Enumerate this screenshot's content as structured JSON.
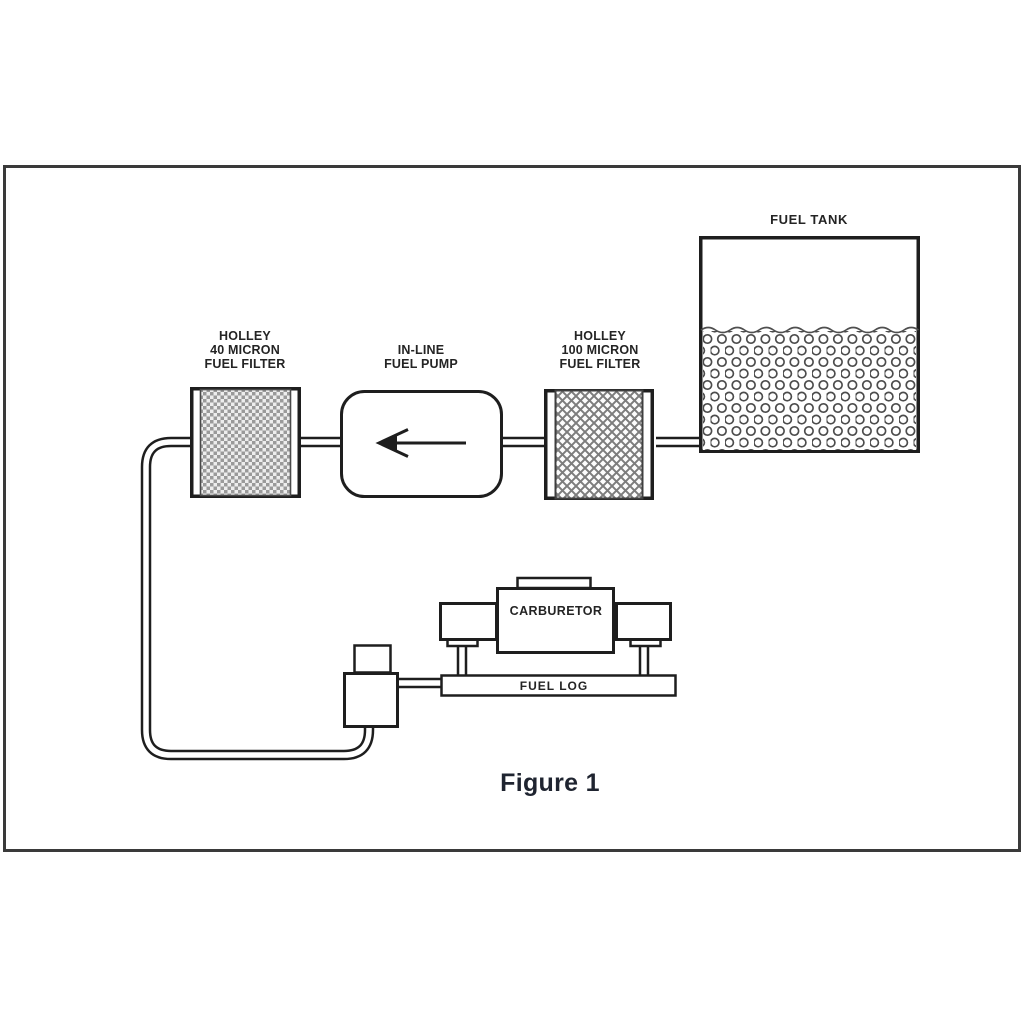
{
  "figure": {
    "caption": "Figure 1"
  },
  "diagram": {
    "fuel_tank": {
      "label": "FUEL TANK"
    },
    "filter_40_micron": {
      "label": "HOLLEY\n40 MICRON\nFUEL FILTER"
    },
    "inline_fuel_pump": {
      "label": "IN-LINE\nFUEL PUMP"
    },
    "filter_100_micron": {
      "label": "HOLLEY\n100 MICRON\nFUEL FILTER"
    },
    "carburetor": {
      "label": "CARBURETOR"
    },
    "fuel_log": {
      "label": "FUEL LOG"
    },
    "flow_direction": "left",
    "colors": {
      "line": "#1e1e1e",
      "frame": "#3a3a3a",
      "text": "#242424",
      "pattern_gray": "#9a9a9a"
    }
  }
}
